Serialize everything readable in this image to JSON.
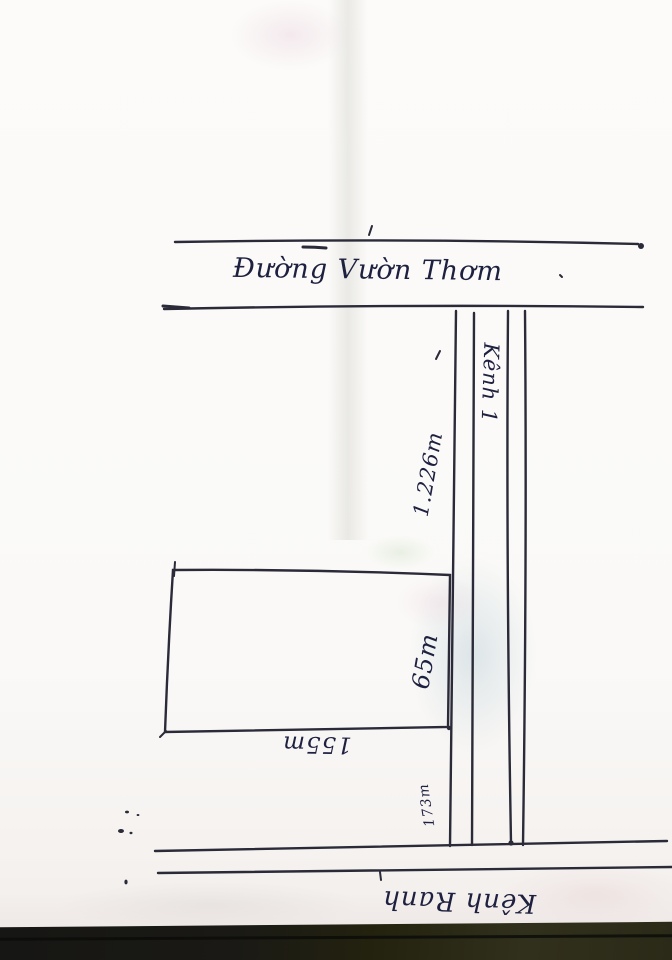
{
  "labels": {
    "top_road": "Đường Vườn Thơm",
    "canal": "Kênh 1",
    "bottom_road": "Kênh Ranh"
  },
  "dimensions": {
    "canal_frontage": "1.226m",
    "plot_right_side": "65m",
    "plot_bottom_side": "155m",
    "segment_below_plot": "173m"
  },
  "colors": {
    "paper": "#fbfaf8",
    "line_ink": "#2a2a38",
    "text_ink": "#1e2040",
    "photo_edge": "#1d1c14"
  }
}
